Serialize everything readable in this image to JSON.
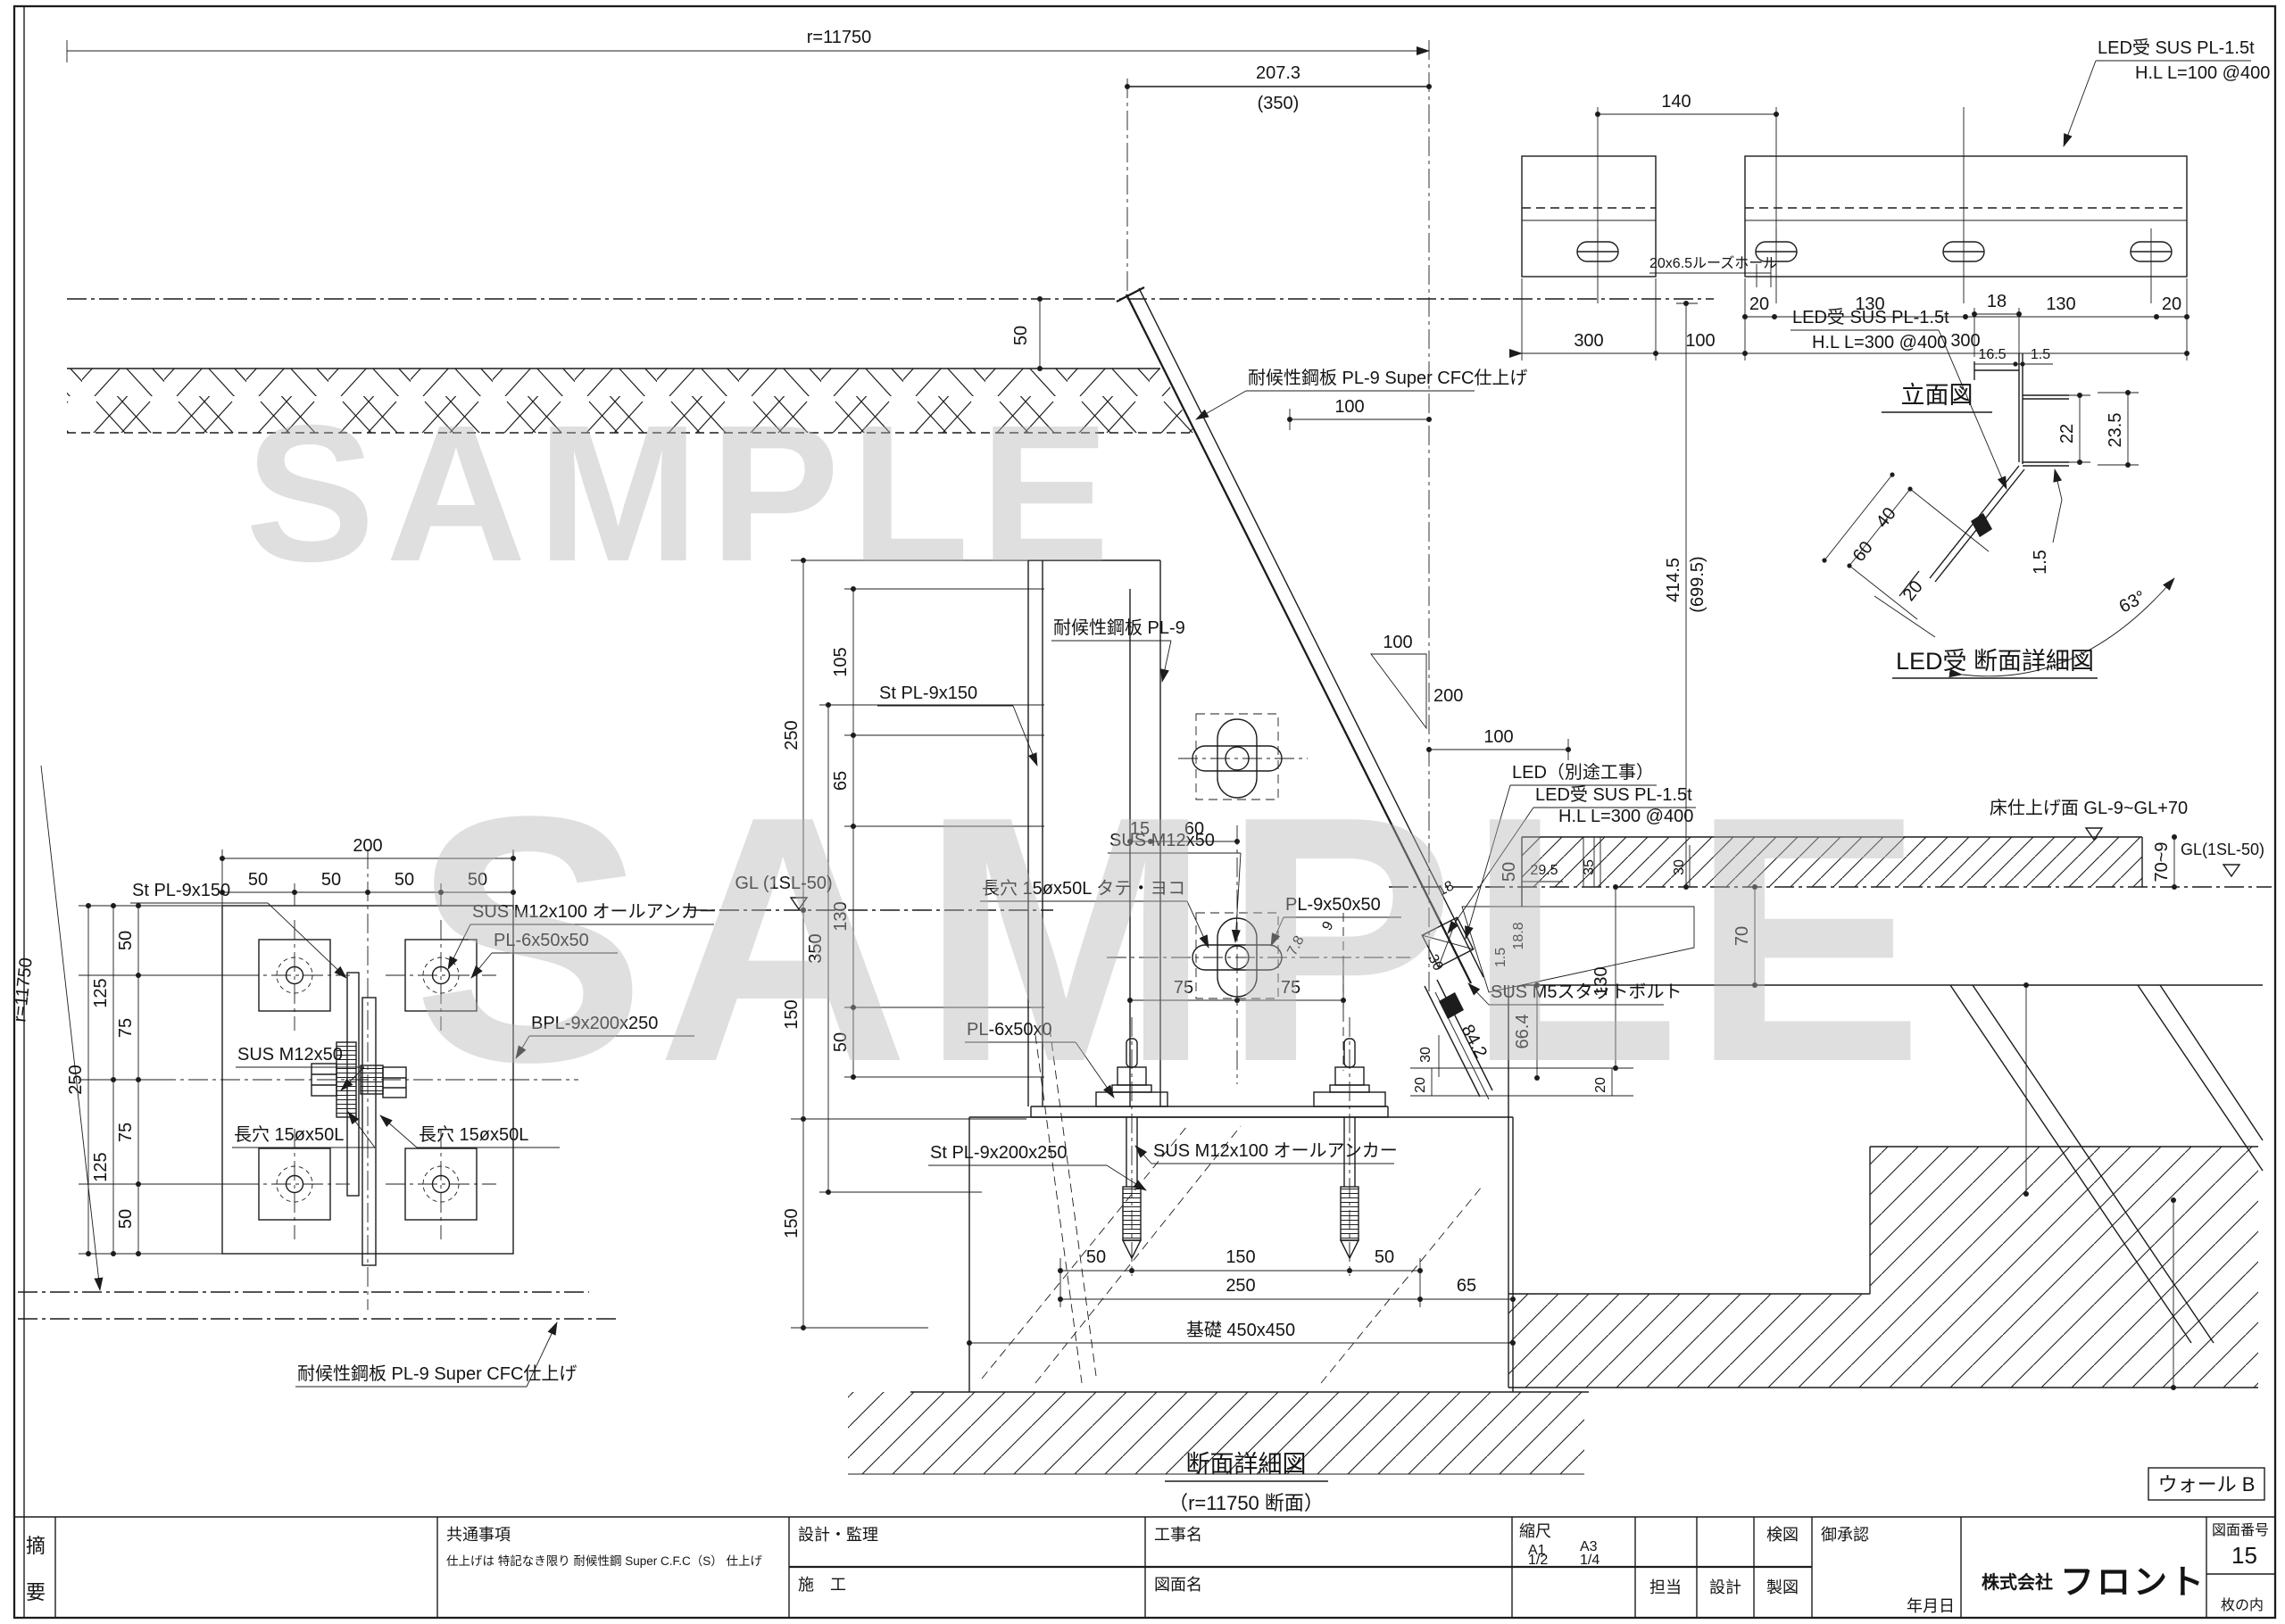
{
  "watermark": "SAMPLE",
  "elevation": {
    "title": "立面図",
    "labels": [
      "LED受 SUS PL-1.5t",
      "H.L L=100 @400",
      "20x6.5ルーズホール"
    ],
    "dims": [
      "140",
      "20",
      "130",
      "130",
      "20",
      "300",
      "100",
      "300"
    ]
  },
  "led_detail": {
    "title": "LED受 断面詳細図",
    "labels": [
      "LED受 SUS PL-1.5t",
      "H.L L=300 @400"
    ],
    "dims": [
      "18",
      "16.5",
      "1.5",
      "22",
      "23.5",
      "1.5",
      "40",
      "60",
      "20",
      "63°"
    ]
  },
  "base_plan": {
    "labels": [
      "St PL-9x150",
      "SUS M12x100 オールアンカー",
      "PL-6x50x50",
      "BPL-9x200x250",
      "SUS M12x50",
      "長穴 15øx50L",
      "長穴 15øx50L",
      "耐候性鋼板 PL-9 Super CFC仕上げ"
    ],
    "dims": [
      "200",
      "50",
      "50",
      "50",
      "50",
      "250",
      "125",
      "125",
      "50",
      "75",
      "75",
      "50",
      "r=11750"
    ]
  },
  "section": {
    "title": "断面詳細図",
    "subtitle": "（r=11750 断面）",
    "wall_tag": "ウォール B",
    "labels": [
      "耐候性鋼板 PL-9 Super CFC仕上げ",
      "耐候性鋼板 PL-9",
      "St PL-9x150",
      "SUS M12x50",
      "長穴 15øx50L タテ・ヨコ",
      "PL-9x50x50",
      "PL-6x50x0",
      "St PL-9x200x250",
      "SUS M12x100 オールアンカー",
      "SUS M5スタットボルト",
      "LED（別途工事）",
      "LED受 SUS PL-1.5t",
      "H.L L=300 @400",
      "基礎 450x450"
    ],
    "levels": [
      "GL (1SL-50)",
      "床仕上げ面 GL-9~GL+70",
      "GL(1SL-50)"
    ],
    "dims": [
      "r=11750",
      "207.3",
      "(350)",
      "50",
      "105",
      "65",
      "130",
      "350",
      "250",
      "150",
      "50",
      "150",
      "15",
      "60",
      "75",
      "75",
      "100",
      "200",
      "100",
      "100",
      "414.5",
      "(699.5)",
      "50",
      "29.5",
      "35",
      "30",
      "70~9",
      "70",
      "130",
      "66.4",
      "84.2",
      "30",
      "30",
      "20",
      "20",
      "1.5",
      "18.8",
      "7.8",
      "9",
      "18",
      "50",
      "150",
      "50",
      "250",
      "65"
    ]
  },
  "title_block": {
    "stamp_top": "摘",
    "stamp_bottom": "要",
    "notes_title": "共通事項",
    "notes_body": "仕上げは 特記なき限り 耐候性鋼  Super C.F.C（S） 仕上げ",
    "design_label": "設計・監理",
    "construction_label": "施　工",
    "project_label": "工事名",
    "drawing_label": "図面名",
    "scale_label": "縮尺",
    "scale_a1": "A1",
    "scale_a1_v": "1/2",
    "scale_a3": "A3",
    "scale_a3_v": "1/4",
    "tanto": "担当",
    "sekkei": "設計",
    "seizu": "製図",
    "kenzu": "検図",
    "approval": "御承認",
    "date_label": "年月日",
    "company_prefix": "株式会社",
    "company_name": "フロント",
    "dwg_no_label": "図面番号",
    "dwg_no": "15",
    "sheet_note": "枚の内"
  }
}
